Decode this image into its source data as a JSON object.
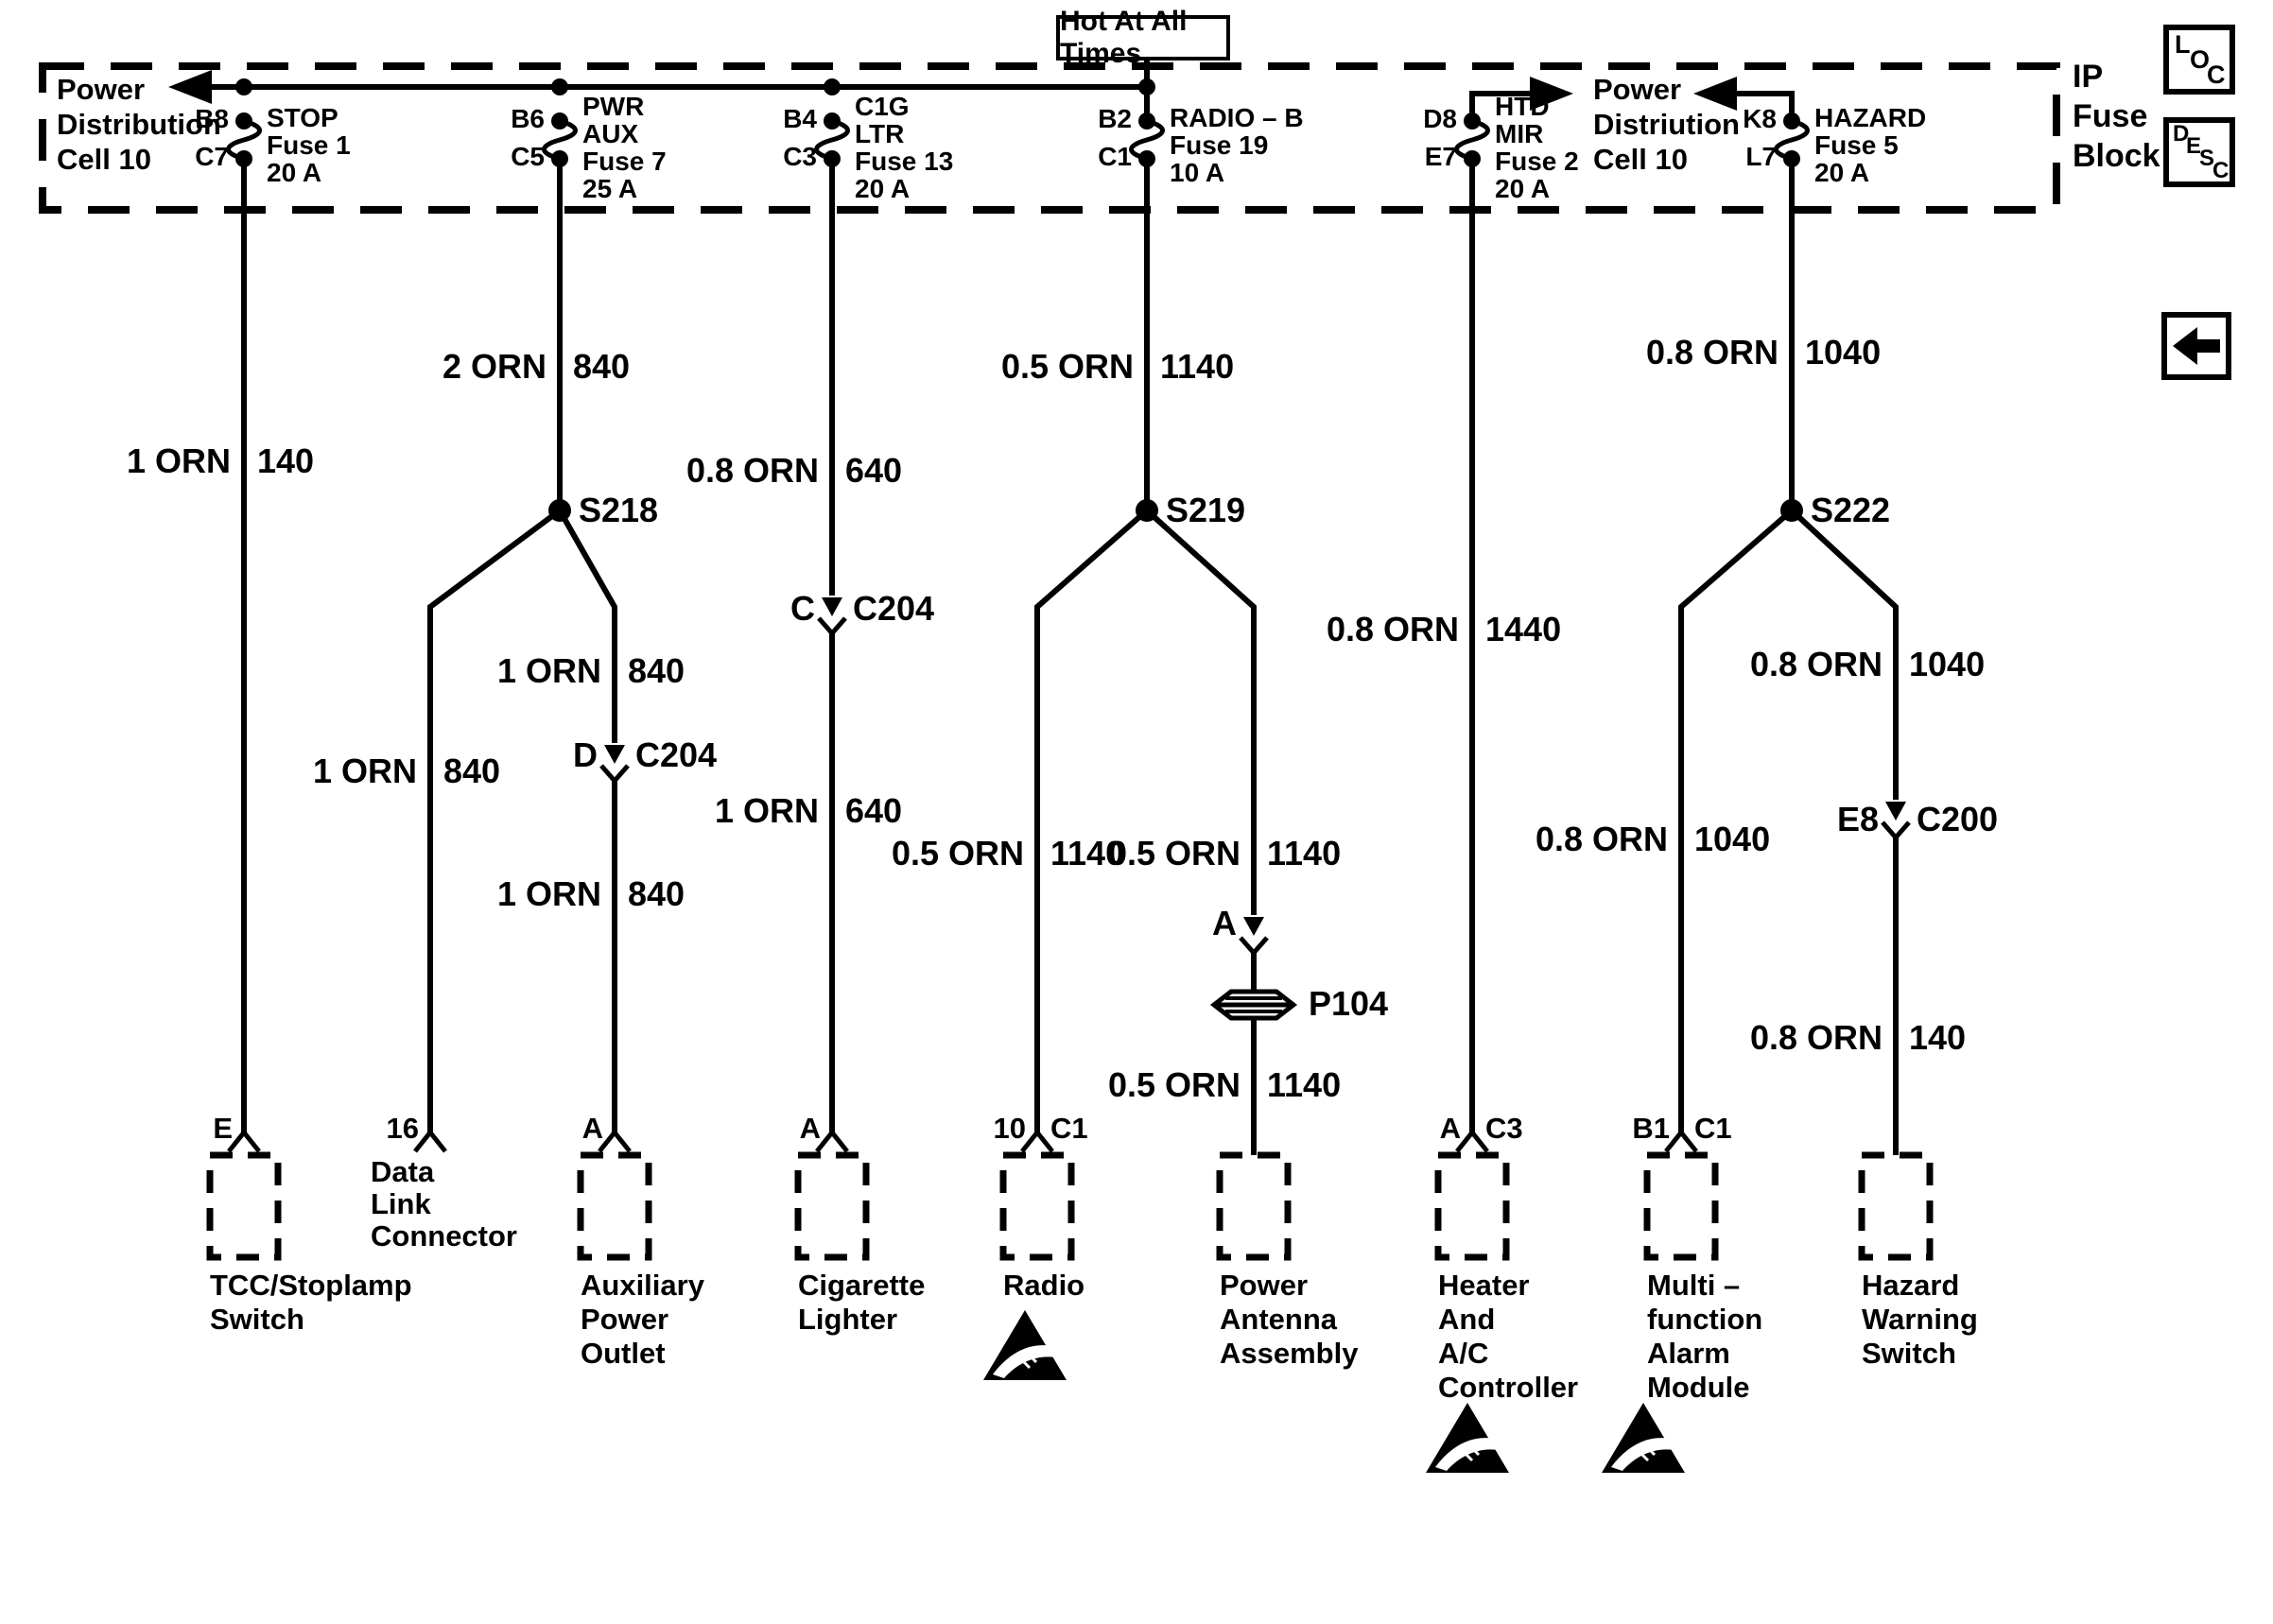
{
  "title_box": "Hot At All Times",
  "ip_label": {
    "l1": "IP",
    "l2": "Fuse",
    "l3": "Block"
  },
  "left_feed": {
    "l1": "Power",
    "l2": "Distribution",
    "l3": "Cell 10"
  },
  "right_feed": {
    "l1": "Power",
    "l2": "Distriution",
    "l3": "Cell 10"
  },
  "fuses": {
    "stop": {
      "top": "B8",
      "bot": "C7",
      "l1": "STOP",
      "l2": "Fuse 1",
      "l3": "20 A"
    },
    "pwraux": {
      "top": "B6",
      "bot": "C5",
      "l1": "PWR",
      "l2": "AUX",
      "l3": "Fuse 7",
      "l4": "25 A"
    },
    "cigltr": {
      "top": "B4",
      "bot": "C3",
      "l1": "C1G",
      "l2": "LTR",
      "l3": "Fuse 13",
      "l4": "20 A"
    },
    "radiob": {
      "top": "B2",
      "bot": "C1",
      "l1": "RADIO – B",
      "l2": "Fuse 19",
      "l3": "10 A"
    },
    "htdmir": {
      "top": "D8",
      "bot": "E7",
      "l1": "HTD",
      "l2": "MIR",
      "l3": "Fuse 2",
      "l4": "20 A"
    },
    "hazard": {
      "top": "K8",
      "bot": "L7",
      "l1": "HAZARD",
      "l2": "Fuse 5",
      "l3": "20 A"
    }
  },
  "wires": {
    "w140": {
      "g": "1 ORN",
      "c": "140"
    },
    "w840a": {
      "g": "2 ORN",
      "c": "840"
    },
    "w840b": {
      "g": "1 ORN",
      "c": "840"
    },
    "w840c": {
      "g": "1 ORN",
      "c": "840"
    },
    "w840d": {
      "g": "1 ORN",
      "c": "840"
    },
    "w640a": {
      "g": "0.8 ORN",
      "c": "640"
    },
    "w640b": {
      "g": "1 ORN",
      "c": "640"
    },
    "w1140a": {
      "g": "0.5 ORN",
      "c": "1140"
    },
    "w1140b": {
      "g": "0.5 ORN",
      "c": "1140"
    },
    "w1140c": {
      "g": "0.5 ORN",
      "c": "1140"
    },
    "w1140d": {
      "g": "0.5 ORN",
      "c": "1140"
    },
    "w1440": {
      "g": "0.8 ORN",
      "c": "1440"
    },
    "w1040a": {
      "g": "0.8 ORN",
      "c": "1040"
    },
    "w1040b": {
      "g": "0.8 ORN",
      "c": "1040"
    },
    "w1040c": {
      "g": "0.8 ORN",
      "c": "1040"
    },
    "w140b": {
      "g": "0.8 ORN",
      "c": "140"
    }
  },
  "splices": {
    "s218": "S218",
    "s219": "S219",
    "s222": "S222"
  },
  "inline_connectors": {
    "c204c": {
      "pin": "C",
      "name": "C204"
    },
    "c204d": {
      "pin": "D",
      "name": "C204"
    },
    "anta": {
      "pin": "A"
    },
    "c200": {
      "pin": "E8",
      "name": "C200"
    },
    "p104": "P104"
  },
  "pins": {
    "tcc": "E",
    "dlc": "16",
    "aux": "A",
    "cig": "A",
    "radio_l": "10",
    "radio_r": "C1",
    "heater_l": "A",
    "heater_r": "C3",
    "multi_l": "B1",
    "multi_r": "C1"
  },
  "components": {
    "tcc": {
      "l1": "TCC/Stoplamp",
      "l2": "Switch"
    },
    "dlc": {
      "l1": "Data",
      "l2": "Link",
      "l3": "Connector"
    },
    "aux": {
      "l1": "Auxiliary",
      "l2": "Power",
      "l3": "Outlet"
    },
    "cig": {
      "l1": "Cigarette",
      "l2": "Lighter"
    },
    "radio": {
      "l1": "Radio"
    },
    "antenna": {
      "l1": "Power",
      "l2": "Antenna",
      "l3": "Assembly"
    },
    "heater": {
      "l1": "Heater",
      "l2": "And",
      "l3": "A/C",
      "l4": "Controller"
    },
    "multi": {
      "l1": "Multi –",
      "l2": "function",
      "l3": "Alarm",
      "l4": "Module"
    },
    "hazard": {
      "l1": "Hazard",
      "l2": "Warning",
      "l3": "Switch"
    }
  },
  "buttons": {
    "loc": [
      "L",
      "O",
      "C"
    ],
    "desc": [
      "D",
      "E",
      "S",
      "C"
    ]
  },
  "colors": {
    "ink": "#000000",
    "paper": "#ffffff"
  }
}
